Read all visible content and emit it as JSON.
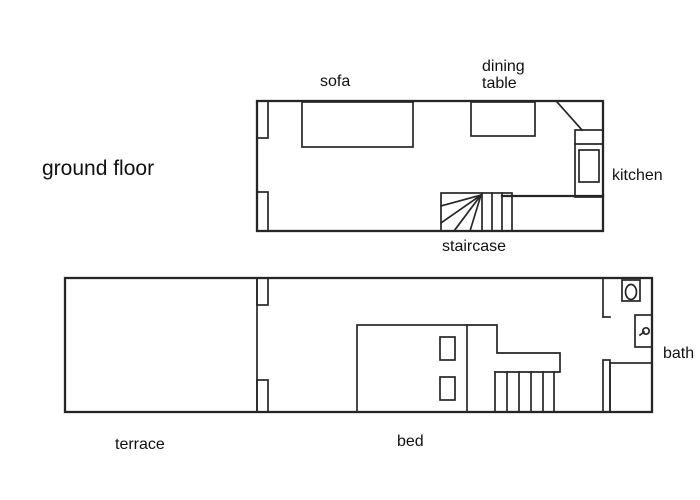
{
  "canvas": {
    "background": "#ffffff",
    "line_color": "#262626",
    "text_color": "#111111"
  },
  "ground_floor": {
    "title": "ground floor",
    "labels": {
      "sofa": "sofa",
      "dining_table": "dining\ntable",
      "kitchen": "kitchen",
      "staircase": "staircase"
    },
    "symbols": [
      "sofa",
      "dining-table",
      "kitchen-door-swing",
      "kitchen-counter",
      "stove",
      "winder-staircase",
      "wall-opening-left"
    ]
  },
  "upper_floor": {
    "labels": {
      "terrace": "terrace",
      "bed": "bed",
      "bath": "bath"
    },
    "symbols": [
      "bed",
      "pillows",
      "staircase",
      "banister",
      "toilet",
      "sink",
      "shower",
      "wall-opening-divider",
      "bathroom-door-opening"
    ]
  }
}
